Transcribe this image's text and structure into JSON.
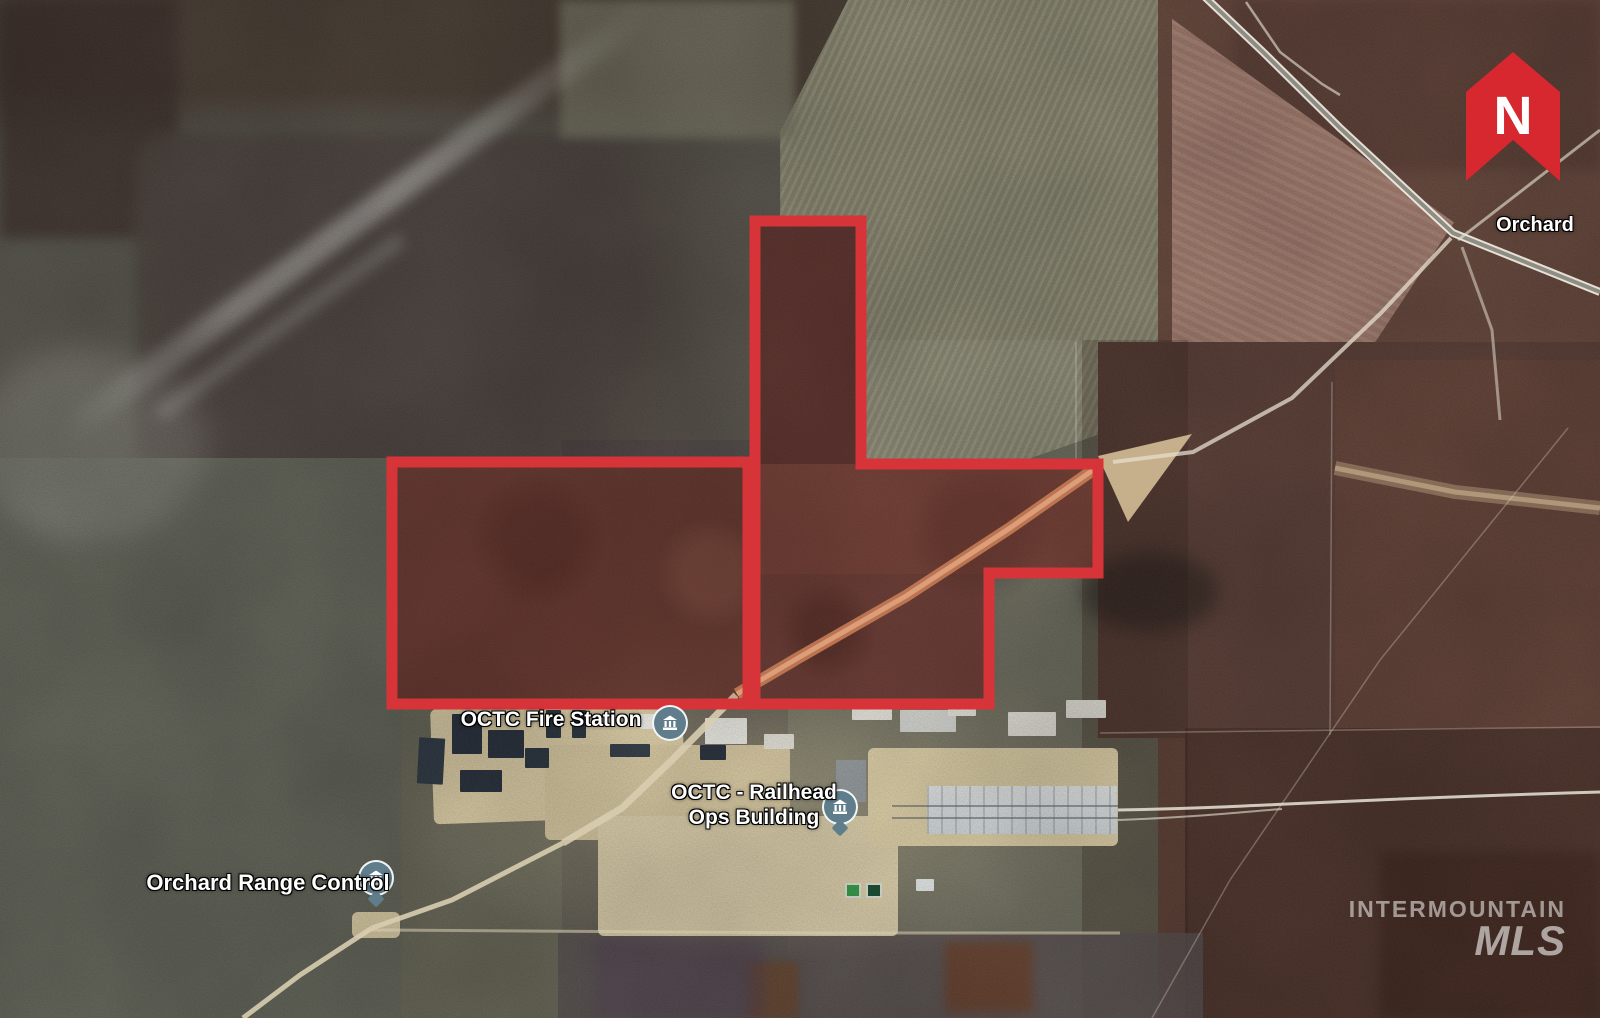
{
  "map": {
    "type": "satellite-aerial-listing-photo",
    "north_letter": "N",
    "labels": {
      "orchard_town": "Orchard",
      "fire_station": "OCTC Fire Station",
      "railhead_line1": "OCTC - Railhead",
      "railhead_line2": "Ops Building",
      "range_control": "Orchard Range Control"
    },
    "watermark": {
      "line1": "INTERMOUNTAIN",
      "line2": "MLS"
    },
    "icons": [
      "north-arrow-icon",
      "poi-building-icon"
    ],
    "colors": {
      "boundary_red": "#d7343a",
      "boundary_fill": "rgba(165,35,30,0.16)",
      "north_marker_red": "#d7272f",
      "poi_icon_bg": "#5f7d8b",
      "dirt_road_tan": "#c98a5e"
    }
  }
}
